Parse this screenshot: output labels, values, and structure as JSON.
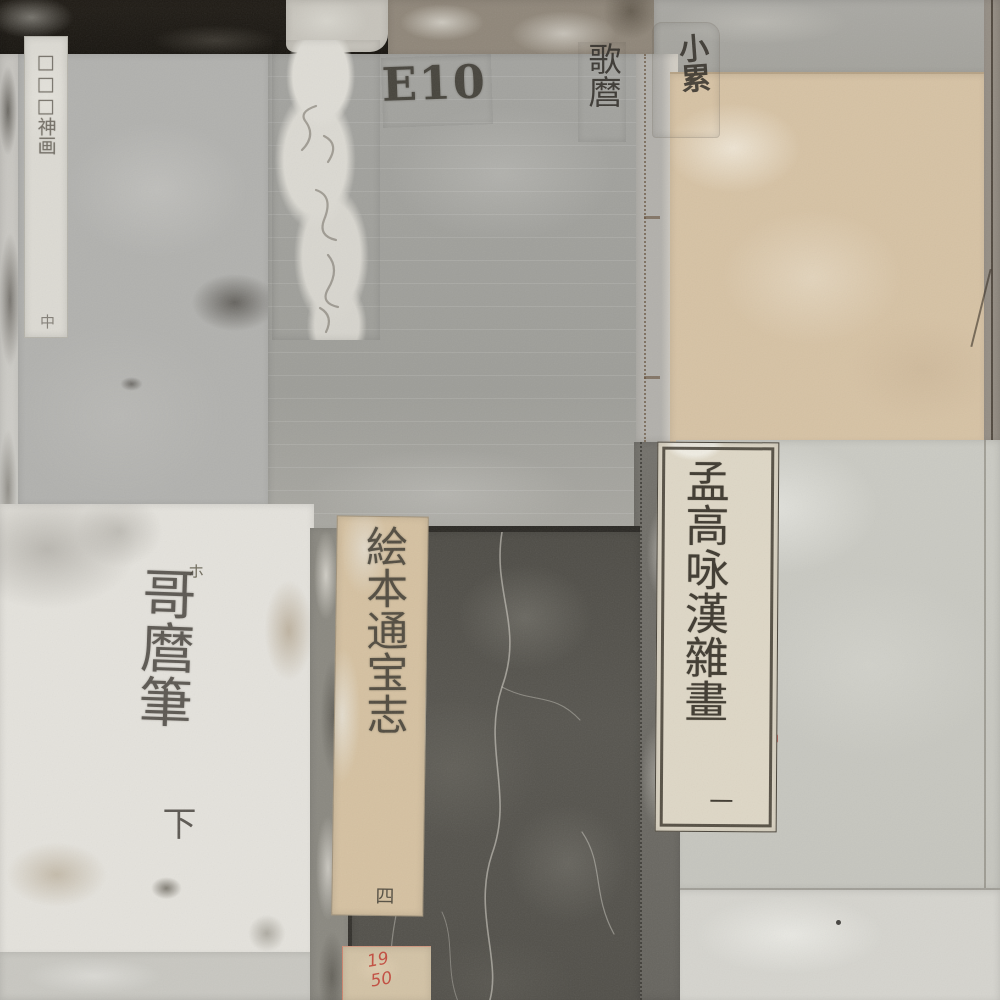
{
  "image": {
    "subject": "Collage of aged Japanese woodblock-book covers, stitched fukurotoji bindings seen flat",
    "style": "photographic patchwork, heavily worn and stained paper"
  },
  "inscriptions": {
    "top_left_slip": {
      "text": "□□□神画",
      "volume": "中"
    },
    "top_right_label": {
      "text": "小累"
    },
    "center_cover": {
      "shelf_mark": "E10",
      "artist": "歌麿"
    },
    "printed_slip": {
      "title": "孟高咏漢雜畫",
      "volume": "一"
    },
    "white_cover": {
      "mark": "ホ",
      "text": "哥麿筆",
      "volume": "下"
    },
    "dark_slip": {
      "title": "絵本通宝志",
      "volume": "四"
    },
    "red_tag": {
      "line1": "19",
      "line2": "50"
    }
  },
  "palette": {
    "black_strip": "#17140f",
    "center_gray_cover": "#a1a19d",
    "left_gray_cover": "#b1b1ae",
    "tan_cover": "#d6c2a4",
    "pale_right_cover": "#c9c9c2",
    "white_cover": "#e4e2dc",
    "dark_charcoal_cover": "#56544e",
    "slip_cream": "#ded7c6",
    "ink": "#3f3a30",
    "red_ink": "#c0392e"
  },
  "panels": [
    {
      "name": "top-black-strip"
    },
    {
      "name": "left-gray-cover-with-title-slip"
    },
    {
      "name": "center-gray-cover-E10-utamaro"
    },
    {
      "name": "tan-cover-top-right"
    },
    {
      "name": "right-pale-cover-with-printed-slip"
    },
    {
      "name": "bottom-left-white-cover-utamaro-hitsu"
    },
    {
      "name": "bottom-center-dark-cover-ehon-slip"
    },
    {
      "name": "bottom-right-pale-cover"
    }
  ]
}
